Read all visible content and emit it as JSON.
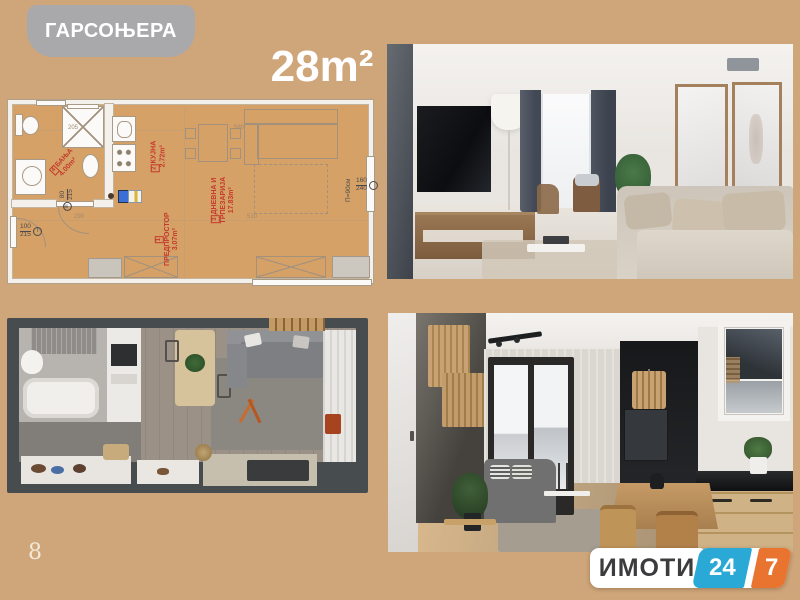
{
  "header": {
    "badge": "ГАРСОЊЕРА",
    "area": "28m²"
  },
  "floor_plan": {
    "rooms": [
      {
        "num": "1",
        "name": "ПРЕДПРОСТОР",
        "area": "3.07m²"
      },
      {
        "num": "2",
        "name": "КУЈНА",
        "area": "2.72m²"
      },
      {
        "num": "3",
        "name": "ДНЕВНА И ТРПЕЗАРИЈА",
        "area": "17.83m²"
      },
      {
        "num": "4",
        "name": "БАЊА",
        "area": "4.00m²"
      }
    ],
    "door_dims": [
      {
        "mark": "I",
        "w": "100",
        "h": "215"
      },
      {
        "mark": "III",
        "w": "80",
        "h": "215"
      }
    ],
    "window_dim": {
      "w": "160",
      "h": "240",
      "parapet": "П=90см"
    },
    "edge_dims": [
      "205",
      "580",
      "290",
      "510"
    ]
  },
  "footer": {
    "page_number": "8",
    "logo": {
      "brand": "ИМОТИ",
      "h24": "24",
      "h7": "7"
    }
  },
  "colors": {
    "background": "#cfa57a",
    "badge_gray": "#a9a9ac",
    "plan_floor": "#d6a167",
    "accent_red": "#c43a2c",
    "logo_blue": "#2ba9d6",
    "logo_orange": "#e8742f"
  }
}
